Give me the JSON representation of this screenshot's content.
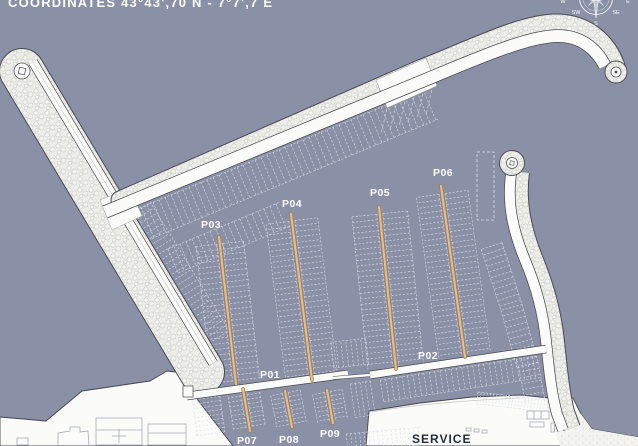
{
  "title": "COORDINATES 43°43',70 N - 7°7',7 E",
  "compass": {
    "w": "W",
    "e": "E",
    "sw": "SW",
    "se": "SE",
    "s": "S"
  },
  "piers": {
    "p01": "P01",
    "p02": "P02",
    "p03": "P03",
    "p04": "P04",
    "p05": "P05",
    "p06": "P06",
    "p07": "P07",
    "p08": "P08",
    "p09": "P09"
  },
  "service": "SERVICE",
  "colors": {
    "water": "#8A90A6",
    "land": "#FBFBF9",
    "pier": "#E9BC8A",
    "pieredge": "#9A7B4E",
    "comb": "#DCE0E9",
    "outline": "#45454E",
    "label": "#FFFFFF",
    "service": "#252E3C"
  }
}
